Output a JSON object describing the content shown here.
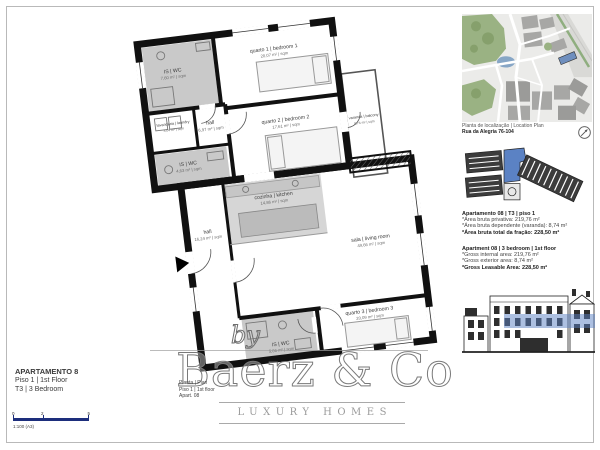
{
  "title_block": {
    "name": "APARTAMENTO 8",
    "floor": "Piso 1 | 1st Floor",
    "type": "T3 | 3 Bedroom"
  },
  "scale_bar": {
    "t0": "0",
    "t1": "2",
    "t2": "5",
    "scale": "1:100 (A3)"
  },
  "plan": {
    "rooms": [
      {
        "name": "quarto 1 | bedroom 1",
        "area": "20,07 m² | sqm"
      },
      {
        "name": "varanda | balcony",
        "area": "8,74 m² | sqm"
      },
      {
        "name": "IS | WC",
        "area": "7,60 m² | sqm"
      },
      {
        "name": "lavandaria | laundry",
        "area": "3,04 m² | sqm"
      },
      {
        "name": "hall",
        "area": "6,97 m² | sqm"
      },
      {
        "name": "quarto 2 | bedroom 2",
        "area": "17,61 m² | sqm"
      },
      {
        "name": "IS | WC",
        "area": "4,63 m² | sqm"
      },
      {
        "name": "cozinha | kitchen",
        "area": "14,86 m² | sqm"
      },
      {
        "name": "hall",
        "area": "16,24 m² | sqm"
      },
      {
        "name": "sala | living room",
        "area": "49,66 m² | sqm"
      },
      {
        "name": "quarto 3 | bedroom 3",
        "area": "20,09 m² | sqm"
      },
      {
        "name": "IS | WC",
        "area": "5,06 m² | sqm"
      }
    ],
    "caption": {
      "l1": "Planta | Plan",
      "l2": "Piso 1 | 1st floor",
      "l3": "Apart. 08"
    }
  },
  "sidebar": {
    "map_caption": "Planta de localização | Location Plan",
    "map_address": "Rua da Alegria 76-104",
    "pt": {
      "title": "Apartamento 08 | T3 | piso 1",
      "l1": "*Área bruta privativa: 219,76 m²",
      "l2": "*Área bruta dependente (varanda): 8,74 m²",
      "l3": "*Área bruta total da fração: 228,50 m²"
    },
    "en": {
      "title": "Apartment 08 | 3 bedroom | 1st floor",
      "l1": "*Gross internal area: 219,76 m²",
      "l2": "*Gross exterior area: 8,74 m²",
      "l3": "*Gross Leasable Area: 228,50 m²"
    }
  },
  "watermark": {
    "by": "by",
    "brand": "Baerz & Co",
    "tagline": "LUXURY HOMES"
  },
  "colors": {
    "highlight_blue": "#5b82c4",
    "scale_navy": "#1d2e7c",
    "park_green": "#9ab283",
    "wall_black": "#111111",
    "room_gray": "#c9c9c9"
  }
}
